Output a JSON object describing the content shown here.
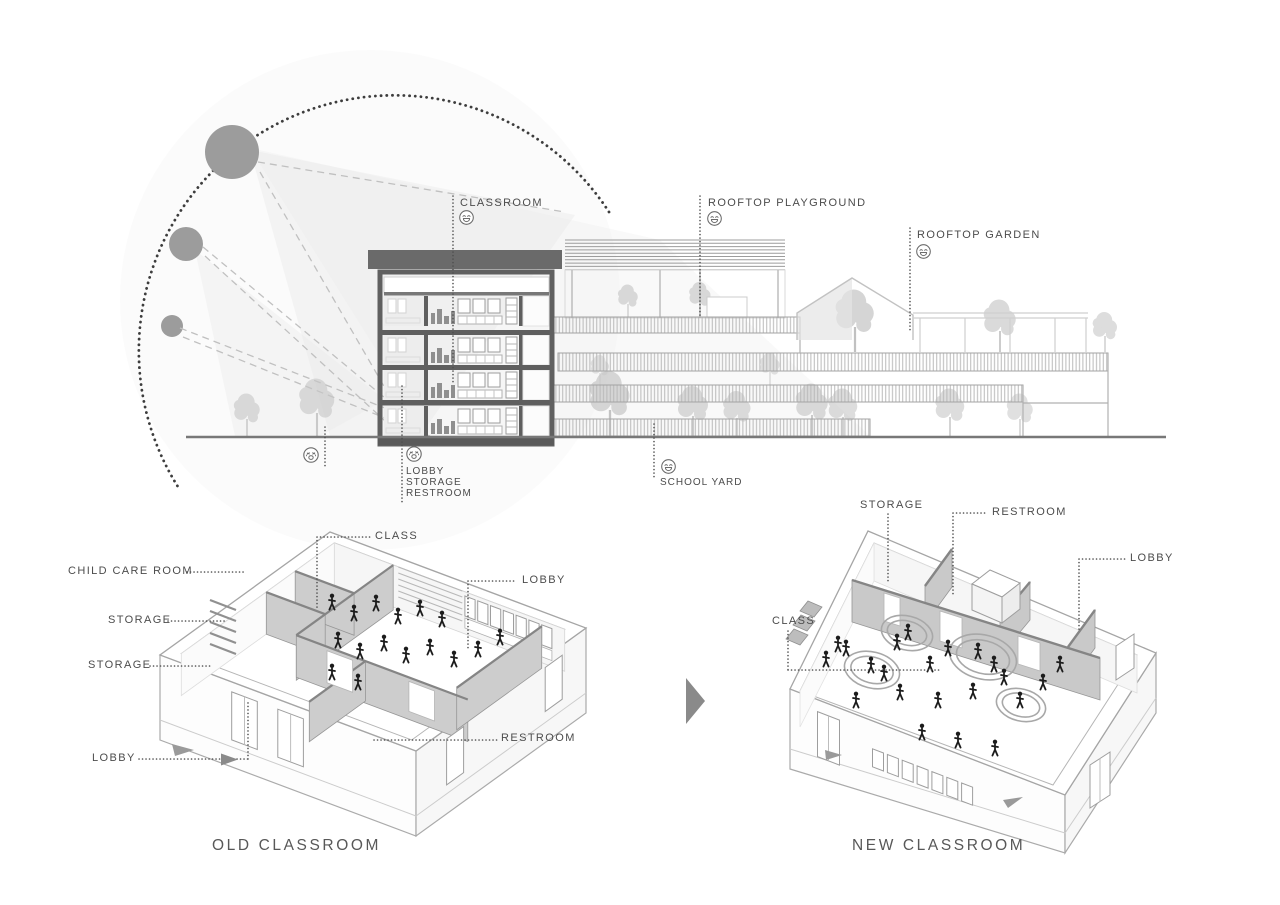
{
  "section": {
    "labels": {
      "classroom": "CLASSROOM",
      "rooftop_playground": "ROOFTOP PLAYGROUND",
      "rooftop_garden": "ROOFTOP GARDEN",
      "lobby": "LOBBY",
      "storage": "STORAGE",
      "restroom": "RESTROOM",
      "school_yard": "SCHOOL YARD"
    },
    "moods": {
      "classroom": "grinning-face",
      "rooftop_playground": "grinning-face",
      "rooftop_garden": "grinning-face",
      "school_yard": "grinning-face",
      "yard_ground": "crying-face",
      "ground_rooms": "crying-face"
    }
  },
  "old_classroom": {
    "title": "OLD CLASSROOM",
    "labels": {
      "class": "CLASS",
      "child_care_room": "CHILD CARE ROOM",
      "storage_1": "STORAGE",
      "storage_2": "STORAGE",
      "lobby_left": "LOBBY",
      "lobby_right": "LOBBY",
      "restroom": "RESTROOM"
    }
  },
  "new_classroom": {
    "title": "NEW CLASSROOM",
    "labels": {
      "storage": "STORAGE",
      "restroom": "RESTROOM",
      "lobby": "LOBBY",
      "class": "CLASS"
    }
  },
  "colors": {
    "text": "#4c4c4c",
    "leader_dots": "#4f4f4f",
    "building_dark": "#5f5f5f",
    "wall_gray": "#cfcfcf",
    "sun_gray": "#9c9c9c",
    "people": "#1c1c1c",
    "arrow": "#8a8a8a"
  }
}
